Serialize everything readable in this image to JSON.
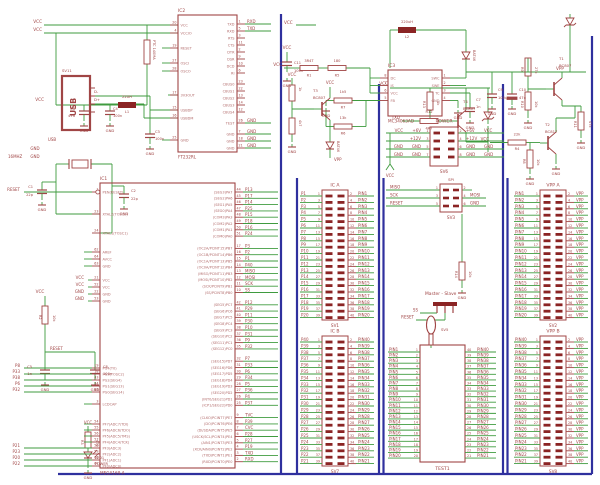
{
  "colors": {
    "wire": "#3f9b3f",
    "part": "#a04545",
    "part_light": "#b26b6b",
    "pad": "#8b2424",
    "frame": "#2f309e",
    "bg": "#ffffff"
  },
  "gnd_label": "GND",
  "chips": {
    "ic1": {
      "refdes": "IC1",
      "part": "MEGA169-A",
      "left": [
        {
          "n": "1",
          "t": "PEN(RESET)",
          "net": "RESET",
          "inv": 1
        },
        {
          "n": "23",
          "t": "XTAL2(TOSC2)",
          "nw": 1
        },
        {
          "n": "24",
          "t": "XTAL1(TOSC1)",
          "nw": 1
        },
        {
          "n": "62",
          "t": "AREF"
        },
        {
          "n": "64",
          "t": "AVCC"
        },
        {
          "n": "63",
          "t": "GND"
        },
        {
          "n": "21",
          "t": "VCC",
          "net": "VCC",
          "nx": 84
        },
        {
          "n": "52",
          "t": "VCC",
          "net": "VCC",
          "nx": 84
        },
        {
          "n": "22",
          "t": "GND",
          "net": "GND",
          "nx": 84
        },
        {
          "n": "53",
          "t": "GND",
          "net": "GND",
          "nx": 84
        },
        {
          "n": "19",
          "t": "PG4(T0)",
          "net": "P8"
        },
        {
          "n": "18",
          "t": "PG3(TOSC2)",
          "net": "P33"
        },
        {
          "n": "43",
          "t": "PG2(SEG4)",
          "net": "P38"
        },
        {
          "n": "34",
          "t": "PG1(SEG13)",
          "net": "P6"
        },
        {
          "n": "33",
          "t": "PG0(SEG14)",
          "net": "P32"
        },
        {
          "n": "3",
          "t": "LCDCAP"
        },
        {
          "n": "54",
          "t": "PF7(ADC7/TDI)"
        },
        {
          "n": "55",
          "t": "PF6(ADC6/TDO)"
        },
        {
          "n": "56",
          "t": "PF5(ADC5/TMS)"
        },
        {
          "n": "57",
          "t": "PF4(ADC4/TCK)"
        },
        {
          "n": "58",
          "t": "PF3(ADC3)",
          "net": "P21"
        },
        {
          "n": "59",
          "t": "PF2(ADC2)",
          "net": "P23"
        },
        {
          "n": "60",
          "t": "PF1(ADC1)",
          "net": "P20"
        },
        {
          "n": "61",
          "t": "PF0(ADC0)",
          "net": "P22"
        }
      ],
      "right": [
        {
          "n": "44",
          "t": "(SEG3)PA7",
          "net": "P13"
        },
        {
          "n": "45",
          "t": "(SEG2)PA6",
          "net": "P17"
        },
        {
          "n": "46",
          "t": "(SEG1)PA5",
          "net": "P14"
        },
        {
          "n": "47",
          "t": "(SEG0)PA4",
          "net": "P25"
        },
        {
          "n": "48",
          "t": "(COM3)PA3",
          "net": "P15"
        },
        {
          "n": "49",
          "t": "(COM2)PA2",
          "net": "P18"
        },
        {
          "n": "50",
          "t": "(COM1)PA1",
          "net": "P16"
        },
        {
          "n": "51",
          "t": "(COM0)PA0",
          "net": "P24"
        },
        {
          "n": "17",
          "t": "(OC2A/PCINT15)PB7",
          "net": "P3"
        },
        {
          "n": "16",
          "t": "(OC1B/PCINT14)PB6",
          "net": "P2"
        },
        {
          "n": "15",
          "t": "(OC1A/PCINT13)PB5",
          "net": "P1"
        },
        {
          "n": "14",
          "t": "(OC0A/PCINT12)PB4",
          "net": "P40"
        },
        {
          "n": "13",
          "t": "(MISO/PCINT11)PB3",
          "net": "MISO"
        },
        {
          "n": "12",
          "t": "(MOSI/PCINT10)PB2",
          "net": "MOSI"
        },
        {
          "n": "11",
          "t": "(SCK/PCINT9)PB1",
          "net": "SCK"
        },
        {
          "n": "10",
          "t": "(SS/PCINT8)PB0",
          "net": "SS"
        },
        {
          "n": "42",
          "t": "(SEG5)PC7",
          "net": "P12"
        },
        {
          "n": "41",
          "t": "(SEG6)PC6",
          "net": "P29"
        },
        {
          "n": "40",
          "t": "(SEG7)PC5",
          "net": "P11"
        },
        {
          "n": "39",
          "t": "(SEG8)PC4",
          "net": "P30"
        },
        {
          "n": "38",
          "t": "(SEG9)PC3",
          "net": "P10"
        },
        {
          "n": "37",
          "t": "(SEG10)PC2",
          "net": "P31"
        },
        {
          "n": "36",
          "t": "(SEG11)PC1",
          "net": "P9"
        },
        {
          "n": "35",
          "t": "(SEG12)PC0",
          "net": "P32"
        },
        {
          "n": "32",
          "t": "(SEG15)PD7",
          "net": "P7"
        },
        {
          "n": "31",
          "t": "(SEG16)PD6",
          "net": "P33"
        },
        {
          "n": "30",
          "t": "(SEG17)PD5",
          "net": "P6"
        },
        {
          "n": "29",
          "t": "(SEG18)PD4",
          "net": "P34"
        },
        {
          "n": "28",
          "t": "(SEG19)PD3",
          "net": "P5"
        },
        {
          "n": "27",
          "t": "(SEG20)PD2",
          "net": "P36"
        },
        {
          "n": "26",
          "t": "(INT0/SEG21)PD1",
          "net": "P4"
        },
        {
          "n": "25",
          "t": "(ICP1/SEG22)PD0",
          "net": "P37"
        },
        {
          "n": "9",
          "t": "(CLKO/PCINT7)PE7",
          "net": "TVC"
        },
        {
          "n": "8",
          "t": "(DO/PCINT6)PE6",
          "net": "P39"
        },
        {
          "n": "7",
          "t": "(DI/SDA/PCINT5)PE5",
          "net": "CVC"
        },
        {
          "n": "6",
          "t": "(USCK/SCL/PCINT4)PE4",
          "net": "P28"
        },
        {
          "n": "5",
          "t": "(AIN1/PCINT3)PE3",
          "net": "P27"
        },
        {
          "n": "4",
          "t": "(XCK/AIN0/PCINT2)PE2",
          "net": "P19"
        },
        {
          "n": "3",
          "t": "(TXD/PCINT1)PE1",
          "net": "TXD"
        },
        {
          "n": "2",
          "t": "(RXD/PCINT0)PE0",
          "net": "RXD"
        }
      ]
    },
    "ic2": {
      "refdes": "IC2",
      "part": "FT232RL",
      "left": [
        {
          "n": "20",
          "t": "VCC",
          "nw": 1
        },
        {
          "n": "4",
          "t": "VCCIO",
          "nw": 1
        },
        {
          "n": "19",
          "t": "RESET"
        },
        {
          "n": "27",
          "t": "OSCI"
        },
        {
          "n": "28",
          "t": "OSCO"
        },
        {
          "n": "17",
          "t": "3V3OUT",
          "nw": 1
        },
        {
          "n": "15",
          "t": "USBDP",
          "nw": 1
        },
        {
          "n": "16",
          "t": "USBDM",
          "nw": 1
        },
        {
          "n": "25",
          "t": "GND"
        }
      ],
      "right": [
        {
          "n": "1",
          "t": "TXD",
          "net": "RXD"
        },
        {
          "n": "5",
          "t": "RXD",
          "net": "TXD"
        },
        {
          "n": "3",
          "t": "RTS"
        },
        {
          "n": "11",
          "t": "CTS"
        },
        {
          "n": "2",
          "t": "DTR"
        },
        {
          "n": "9",
          "t": "DSR"
        },
        {
          "n": "10",
          "t": "DCD"
        },
        {
          "n": "6",
          "t": "RI"
        },
        {
          "n": "23",
          "t": "CBUS0"
        },
        {
          "n": "22",
          "t": "CBUS1"
        },
        {
          "n": "13",
          "t": "CBUS2"
        },
        {
          "n": "14",
          "t": "CBUS3"
        },
        {
          "n": "12",
          "t": "CBUS4"
        },
        {
          "n": "26",
          "t": "TEST",
          "net": "GND"
        },
        {
          "n": "7",
          "t": "GND",
          "net": "GND"
        },
        {
          "n": "18",
          "t": "GND",
          "net": "GND"
        },
        {
          "n": "21",
          "t": "GND",
          "net": "GND"
        }
      ]
    },
    "ic3": {
      "refdes": "IC3",
      "part": "MC34063AD",
      "left": [
        {
          "n": "8",
          "t": "DC"
        },
        {
          "n": "7",
          "t": "IS"
        },
        {
          "n": "6",
          "t": "VCC"
        },
        {
          "n": "5",
          "t": "FB"
        }
      ],
      "right": [
        {
          "n": "1",
          "t": "SWC"
        },
        {
          "n": "2",
          "t": "SWE"
        },
        {
          "n": "3",
          "t": "TC"
        },
        {
          "n": "4",
          "t": "GND"
        }
      ]
    }
  },
  "connectors": {
    "sv1": {
      "title": "IC A",
      "refdes": "SV1",
      "left_nets": [
        "P1",
        "P2",
        "P3",
        "P4",
        "P5",
        "P6",
        "P7",
        "P8",
        "P9",
        "P10",
        "P11",
        "P12",
        "P13",
        "P14",
        "P15",
        "P16",
        "P17",
        "P18",
        "P19",
        "P20"
      ],
      "left_nums": [
        "1",
        "3",
        "5",
        "7",
        "9",
        "11",
        "13",
        "15",
        "17",
        "19",
        "21",
        "23",
        "25",
        "27",
        "29",
        "31",
        "33",
        "35",
        "37",
        "39"
      ],
      "right_nums": [
        "2",
        "4",
        "6",
        "8",
        "10",
        "12",
        "14",
        "16",
        "18",
        "20",
        "22",
        "24",
        "26",
        "28",
        "30",
        "32",
        "34",
        "36",
        "38",
        "40"
      ],
      "right_nets": [
        "PIN1",
        "PIN2",
        "PIN3",
        "PIN4",
        "PIN5",
        "PIN6",
        "PIN7",
        "PIN8",
        "PIN9",
        "PIN10",
        "PIN11",
        "PIN12",
        "PIN13",
        "PIN14",
        "PIN15",
        "PIN16",
        "PIN17",
        "PIN18",
        "PIN19",
        "PIN20"
      ]
    },
    "sv7": {
      "title": "IC B",
      "refdes": "SV7",
      "left_nets": [
        "P40",
        "P39",
        "P38",
        "P37",
        "P36",
        "P35",
        "P34",
        "P33",
        "P32",
        "P31",
        "P30",
        "P29",
        "P28",
        "P27",
        "P26",
        "P25",
        "P24",
        "P23",
        "P22",
        "P21"
      ],
      "left_nums": [
        "1",
        "3",
        "5",
        "7",
        "9",
        "11",
        "13",
        "15",
        "17",
        "19",
        "21",
        "23",
        "25",
        "27",
        "29",
        "31",
        "33",
        "35",
        "37",
        "39"
      ],
      "right_nums": [
        "2",
        "4",
        "6",
        "8",
        "10",
        "12",
        "14",
        "16",
        "18",
        "20",
        "22",
        "24",
        "26",
        "28",
        "30",
        "32",
        "34",
        "36",
        "38",
        "40"
      ],
      "right_nets": [
        "PIN40",
        "PIN39",
        "PIN38",
        "PIN37",
        "PIN36",
        "PIN35",
        "PIN34",
        "PIN33",
        "PIN32",
        "PIN31",
        "PIN30",
        "PIN29",
        "PIN28",
        "PIN27",
        "PIN26",
        "PIN25",
        "PIN24",
        "PIN23",
        "PIN22",
        "PIN21"
      ]
    },
    "sv2": {
      "title": "VPP A",
      "refdes": "SV2",
      "left_nets": [
        "PIN1",
        "PIN2",
        "PIN3",
        "PIN4",
        "PIN5",
        "PIN6",
        "PIN7",
        "PIN8",
        "PIN9",
        "PIN10",
        "PIN11",
        "PIN12",
        "PIN13",
        "PIN14",
        "PIN15",
        "PIN16",
        "PIN17",
        "PIN18",
        "PIN19",
        "PIN20"
      ],
      "left_nums": [
        "1",
        "3",
        "5",
        "7",
        "9",
        "11",
        "13",
        "15",
        "17",
        "19",
        "21",
        "23",
        "25",
        "27",
        "29",
        "31",
        "33",
        "35",
        "37",
        "39"
      ],
      "right_nums": [
        "2",
        "4",
        "6",
        "8",
        "10",
        "12",
        "14",
        "16",
        "18",
        "20",
        "22",
        "24",
        "26",
        "28",
        "30",
        "32",
        "34",
        "36",
        "38",
        "40"
      ],
      "right_nets": [
        "VPP",
        "VPP",
        "VPP",
        "VPP",
        "VPP",
        "VPP",
        "VPP",
        "VPP",
        "VPP",
        "VPP",
        "VPP",
        "VPP",
        "VPP",
        "VPP",
        "VPP",
        "VPP",
        "VPP",
        "VPP",
        "VPP",
        "VPP"
      ]
    },
    "sv8": {
      "title": "VPP B",
      "refdes": "SV8",
      "left_nets": [
        "PIN40",
        "PIN39",
        "PIN38",
        "PIN37",
        "PIN36",
        "PIN35",
        "PIN34",
        "PIN33",
        "PIN32",
        "PIN31",
        "PIN30",
        "PIN29",
        "PIN28",
        "PIN27",
        "PIN26",
        "PIN25",
        "PIN24",
        "PIN23",
        "PIN22",
        "PIN21"
      ],
      "left_nums": [
        "1",
        "3",
        "5",
        "7",
        "9",
        "11",
        "13",
        "15",
        "17",
        "19",
        "21",
        "23",
        "25",
        "27",
        "29",
        "31",
        "33",
        "35",
        "37",
        "39"
      ],
      "right_nums": [
        "2",
        "4",
        "6",
        "8",
        "10",
        "12",
        "14",
        "16",
        "18",
        "20",
        "22",
        "24",
        "26",
        "28",
        "30",
        "32",
        "34",
        "36",
        "38",
        "40"
      ],
      "right_nets": [
        "VPP",
        "VPP",
        "VPP",
        "VPP",
        "VPP",
        "VPP",
        "VPP",
        "VPP",
        "VPP",
        "VPP",
        "VPP",
        "VPP",
        "VPP",
        "VPP",
        "VPP",
        "VPP",
        "VPP",
        "VPP",
        "VPP",
        "VPP"
      ]
    },
    "sv6": {
      "title": "POWER",
      "refdes": "SV6",
      "rows": [
        {
          "ol": "VCC",
          "l": "+6V",
          "r": "+6V",
          "or": "VCC"
        },
        {
          "ol": "",
          "l": "+12V",
          "r": "+12V",
          "or": ""
        },
        {
          "ol": "GND",
          "l": "GND",
          "r": "GND",
          "or": "GND"
        },
        {
          "ol": "GND",
          "l": "GND",
          "r": "GND",
          "or": "GND"
        }
      ],
      "left_nums": [
        "1",
        "3",
        "5",
        "7"
      ],
      "right_nums": [
        "2",
        "4",
        "6",
        "8"
      ]
    },
    "sv3": {
      "title": "SPI",
      "refdes": "SV3",
      "left_nets": [
        "MISO",
        "SCK",
        "RESET"
      ],
      "left_nums": [
        "1",
        "3",
        "5"
      ],
      "right_nums": [
        "2",
        "4",
        "6"
      ],
      "right_nets": [
        "",
        "MOSI",
        "GND"
      ]
    }
  },
  "zif": {
    "refdes": "TEST1",
    "lever_label": "SV5",
    "left_nets": [
      "PIN1",
      "PIN2",
      "PIN3",
      "PIN4",
      "PIN5",
      "PIN6",
      "PIN7",
      "PIN8",
      "PIN9",
      "PIN10",
      "PIN11",
      "PIN12",
      "PIN13",
      "PIN14",
      "PIN15",
      "PIN16",
      "PIN17",
      "PIN18",
      "PIN19",
      "PIN20"
    ],
    "left_nums": [
      "1",
      "2",
      "3",
      "4",
      "5",
      "6",
      "7",
      "8",
      "9",
      "10",
      "11",
      "12",
      "13",
      "14",
      "15",
      "16",
      "17",
      "18",
      "19",
      "20"
    ],
    "right_nums": [
      "40",
      "39",
      "38",
      "37",
      "36",
      "35",
      "34",
      "33",
      "32",
      "31",
      "30",
      "29",
      "28",
      "27",
      "26",
      "25",
      "24",
      "23",
      "22",
      "21"
    ],
    "right_nets": [
      "PIN40",
      "PIN39",
      "PIN38",
      "PIN37",
      "PIN36",
      "PIN35",
      "PIN34",
      "PIN33",
      "PIN32",
      "PIN31",
      "PIN30",
      "PIN29",
      "PIN28",
      "PIN27",
      "PIN26",
      "PIN25",
      "PIN24",
      "PIN23",
      "PIN22",
      "PIN21"
    ]
  },
  "jumper": {
    "label": "Master - Slave",
    "net_a": "SS",
    "net_b": "RESET"
  },
  "usb": {
    "refdes": "SV11",
    "face": "USB"
  },
  "misc_labels": [
    "VCC",
    "VCC",
    "VCC",
    "C6",
    "47u",
    "C4",
    "100n",
    "22UH",
    "L1",
    "PTC 140MA",
    "SV11",
    "D-",
    "D+",
    "USB",
    "GND",
    "GND",
    "C3",
    "100n",
    "VCC",
    "VCC",
    "3R4T",
    "R1",
    "180",
    "R5",
    "VCC",
    "C11",
    "100n",
    "220uH",
    "L2",
    "BAT46",
    "1k5",
    "R7",
    "13k",
    "R6",
    "C7",
    "1n",
    "C9",
    "100uF",
    "C10",
    "47u",
    "VPP",
    "T1",
    "BC807",
    "27k",
    "R9",
    "10k",
    "R10",
    "47k",
    "R11",
    "T2",
    "BC817",
    "22k",
    "R4",
    "VCC",
    "10k",
    "R8",
    "VCC",
    "T3",
    "BC807",
    "1k",
    "4k7",
    "BAT46",
    "VPP",
    "VCC",
    "VCC",
    "TXD",
    "R12",
    "4K7",
    "1k",
    "R13",
    "T4",
    "BC807",
    "10k",
    "R14",
    "VCC",
    "16MHZ",
    "C1",
    "22p",
    "C2",
    "22p",
    "VCC",
    "R2",
    "10k",
    "RESET",
    "C5",
    "1n",
    "C8",
    "100n",
    "VCC",
    "R3",
    "470",
    "LED1",
    "POWER",
    "SV5"
  ]
}
